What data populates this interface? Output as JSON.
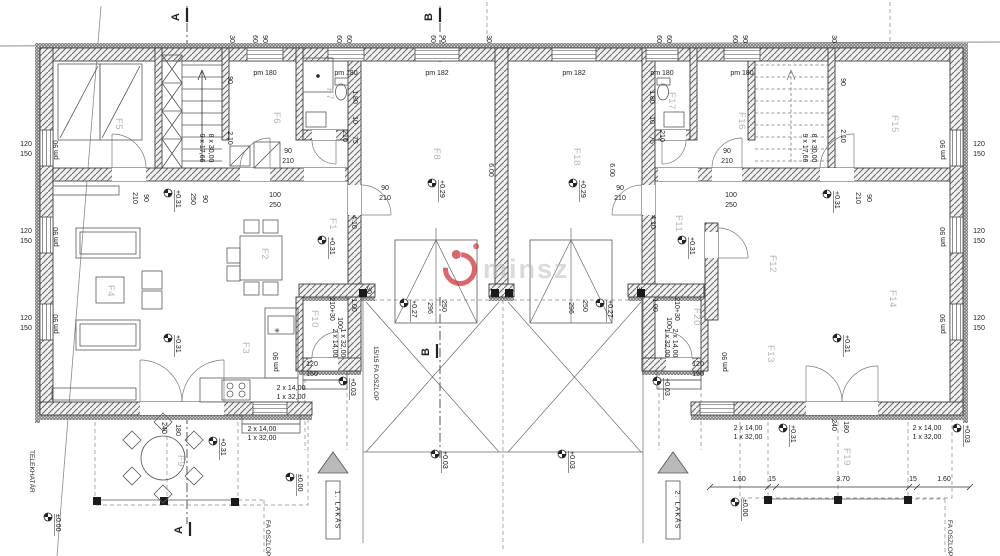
{
  "watermark": {
    "text": "minsz",
    "logo_color": "#c4232b",
    "text_color": "#b5b5b5"
  },
  "apartment_tags": [
    {
      "label": "1. LAKÁS",
      "x": 333
    },
    {
      "label": "2. LAKÁS",
      "x": 673
    }
  ],
  "section_markers": [
    {
      "label": "A",
      "tx": 179,
      "ty": 17,
      "lx": 187,
      "ly": 8
    },
    {
      "label": "B",
      "tx": 432,
      "ty": 17,
      "lx": 440,
      "ly": 8
    },
    {
      "label": "B",
      "tx": 429,
      "ty": 352,
      "lx": 437,
      "ly": 344
    },
    {
      "label": "A",
      "tx": 182,
      "ty": 530,
      "lx": 190,
      "ly": 522
    }
  ],
  "rooms": [
    [
      "F1",
      330,
      218
    ],
    [
      "F2",
      262,
      248
    ],
    [
      "F3",
      243,
      342
    ],
    [
      "F4",
      108,
      285
    ],
    [
      "F5",
      116,
      118
    ],
    [
      "F6",
      274,
      112
    ],
    [
      "F7",
      327,
      88
    ],
    [
      "F8",
      434,
      148
    ],
    [
      "F9",
      178,
      455
    ],
    [
      "F10",
      312,
      310
    ],
    [
      "F11",
      676,
      215
    ],
    [
      "F12",
      770,
      255
    ],
    [
      "F13",
      768,
      345
    ],
    [
      "F14",
      890,
      290
    ],
    [
      "F15",
      892,
      115
    ],
    [
      "F16",
      739,
      112
    ],
    [
      "F17",
      669,
      92
    ],
    [
      "F18",
      574,
      148
    ],
    [
      "F19",
      844,
      448
    ],
    [
      "F20",
      694,
      308
    ]
  ],
  "levels": [
    [
      "+0.31",
      168,
      193
    ],
    [
      "+0.31",
      168,
      338
    ],
    [
      "+0.31",
      322,
      240
    ],
    [
      "+0.29",
      432,
      183
    ],
    [
      "+0.29",
      573,
      183
    ],
    [
      "+0.31",
      682,
      240
    ],
    [
      "+0.31",
      827,
      194
    ],
    [
      "+0.31",
      837,
      338
    ],
    [
      "+0.27",
      404,
      303
    ],
    [
      "+0.27",
      600,
      303
    ],
    [
      "+0.03",
      343,
      381
    ],
    [
      "+0.03",
      657,
      381
    ],
    [
      "+0.03",
      435,
      454
    ],
    [
      "+0.03",
      562,
      454
    ],
    [
      "+0.31",
      213,
      441
    ],
    [
      "+0.31",
      783,
      428
    ],
    [
      "+0.03",
      957,
      428
    ],
    [
      "±0.00",
      290,
      477
    ],
    [
      "±0.00",
      735,
      502
    ],
    [
      "±0.00",
      48,
      517
    ]
  ],
  "dims": [
    [
      "30",
      230,
      39,
      90
    ],
    [
      "60",
      253,
      39,
      90
    ],
    [
      "90",
      263,
      39,
      90
    ],
    [
      "60",
      337,
      39,
      90
    ],
    [
      "60",
      347,
      39,
      90
    ],
    [
      "60",
      431,
      39,
      90
    ],
    [
      "90",
      441,
      39,
      90
    ],
    [
      "30",
      487,
      39,
      90
    ],
    [
      "60",
      657,
      39,
      90
    ],
    [
      "60",
      667,
      39,
      90
    ],
    [
      "60",
      733,
      39,
      90
    ],
    [
      "90",
      743,
      39,
      90
    ],
    [
      "30",
      832,
      39,
      90
    ],
    [
      "pm 180",
      265,
      75,
      0
    ],
    [
      "pm 180",
      346,
      75,
      0
    ],
    [
      "pm 182",
      437,
      75,
      0
    ],
    [
      "pm 182",
      574,
      75,
      0
    ],
    [
      "pm 180",
      662,
      75,
      0
    ],
    [
      "pm 180",
      742,
      75,
      0
    ],
    [
      "120",
      26,
      146,
      0
    ],
    [
      "150",
      26,
      156,
      0
    ],
    [
      "120",
      26,
      233,
      0
    ],
    [
      "150",
      26,
      243,
      0
    ],
    [
      "120",
      26,
      320,
      0
    ],
    [
      "150",
      26,
      330,
      0
    ],
    [
      "pm 90",
      58,
      150,
      -90
    ],
    [
      "pm 90",
      58,
      237,
      -90
    ],
    [
      "pm 90",
      58,
      324,
      -90
    ],
    [
      "120",
      979,
      146,
      0
    ],
    [
      "150",
      979,
      156,
      0
    ],
    [
      "120",
      979,
      233,
      0
    ],
    [
      "150",
      979,
      243,
      0
    ],
    [
      "120",
      979,
      320,
      0
    ],
    [
      "150",
      979,
      330,
      0
    ],
    [
      "pm 90",
      945,
      150,
      -90
    ],
    [
      "pm 90",
      945,
      237,
      -90
    ],
    [
      "pm 90",
      945,
      324,
      -90
    ],
    [
      "90",
      228,
      80,
      90
    ],
    [
      "2.10",
      228,
      138,
      90
    ],
    [
      "9 x 17,66",
      200,
      148,
      90
    ],
    [
      "8 x 30,00",
      209,
      148,
      90
    ],
    [
      "90",
      841,
      82,
      90
    ],
    [
      "2.10",
      841,
      136,
      90
    ],
    [
      "9 x 17,66",
      803,
      148,
      90
    ],
    [
      "8 x 30,00",
      812,
      148,
      90
    ],
    [
      "1.80",
      353,
      97,
      90
    ],
    [
      "10",
      353,
      120,
      90
    ],
    [
      "75",
      353,
      140,
      90
    ],
    [
      "210",
      343,
      136,
      90
    ],
    [
      "1.80",
      650,
      97,
      90
    ],
    [
      "10",
      650,
      120,
      90
    ],
    [
      "75",
      650,
      140,
      90
    ],
    [
      "210",
      660,
      136,
      90
    ],
    [
      "90",
      288,
      153,
      0
    ],
    [
      "210",
      288,
      163,
      0
    ],
    [
      "90",
      727,
      153,
      0
    ],
    [
      "210",
      727,
      163,
      0
    ],
    [
      "210",
      133,
      198,
      90
    ],
    [
      "90",
      144,
      198,
      90
    ],
    [
      "210",
      856,
      198,
      90
    ],
    [
      "90",
      867,
      198,
      90
    ],
    [
      "90",
      385,
      190,
      0
    ],
    [
      "210",
      385,
      200,
      0
    ],
    [
      "90",
      620,
      190,
      0
    ],
    [
      "210",
      620,
      200,
      0
    ],
    [
      "100",
      275,
      197,
      0
    ],
    [
      "250",
      275,
      207,
      0
    ],
    [
      "100",
      731,
      197,
      0
    ],
    [
      "250",
      731,
      207,
      0
    ],
    [
      "250",
      191,
      199,
      90
    ],
    [
      "90",
      203,
      199,
      90
    ],
    [
      "4.10",
      352,
      222,
      90
    ],
    [
      "4.10",
      651,
      222,
      90
    ],
    [
      "6.00",
      489,
      170,
      90
    ],
    [
      "6.00",
      610,
      170,
      90
    ],
    [
      "210+30",
      330,
      309,
      90
    ],
    [
      "1.00",
      352,
      305,
      90
    ],
    [
      "100",
      338,
      323,
      90
    ],
    [
      "210+30",
      675,
      309,
      90
    ],
    [
      "1.00",
      653,
      305,
      90
    ],
    [
      "100",
      667,
      323,
      90
    ],
    [
      "2 x 14,00",
      333,
      343,
      90
    ],
    [
      "1 x 32,00",
      341,
      343,
      90
    ],
    [
      "2 x 14,00",
      673,
      343,
      90
    ],
    [
      "1 x 32,00",
      665,
      343,
      90
    ],
    [
      "120",
      312,
      366,
      0
    ],
    [
      "150",
      312,
      376,
      0
    ],
    [
      "pm 90",
      278,
      362,
      -90
    ],
    [
      "120",
      698,
      366,
      0
    ],
    [
      "150",
      698,
      376,
      0
    ],
    [
      "pm 90",
      727,
      362,
      -90
    ],
    [
      "296",
      428,
      308,
      90
    ],
    [
      "250",
      442,
      306,
      90
    ],
    [
      "296",
      569,
      308,
      90
    ],
    [
      "250",
      583,
      306,
      90
    ],
    [
      "30",
      367,
      290,
      90
    ],
    [
      "30",
      637,
      290,
      90
    ],
    [
      "240",
      162,
      428,
      90
    ],
    [
      "180",
      176,
      430,
      90
    ],
    [
      "240",
      832,
      425,
      90
    ],
    [
      "180",
      844,
      427,
      90
    ],
    [
      "2 x 14,00",
      262,
      431,
      0
    ],
    [
      "1 x 32,00",
      262,
      440,
      0
    ],
    [
      "2 x 14,00",
      291,
      390,
      0
    ],
    [
      "1 x 32,00",
      291,
      399,
      0
    ],
    [
      "2 x 14,00",
      748,
      430,
      0
    ],
    [
      "1 x 32,00",
      748,
      439,
      0
    ],
    [
      "2 x 14,00",
      927,
      430,
      0
    ],
    [
      "1 x 32,00",
      927,
      439,
      0
    ],
    [
      "1.60",
      739,
      481,
      0
    ],
    [
      "15",
      772,
      481,
      0
    ],
    [
      "3.70",
      843,
      481,
      0
    ],
    [
      "15",
      913,
      481,
      0
    ],
    [
      "1.60",
      944,
      481,
      0
    ],
    [
      "✳",
      277,
      333,
      0
    ]
  ],
  "notes": [
    [
      "15/15 FA OSZLOP",
      374,
      346
    ],
    [
      "FA OSZLOP",
      266,
      520
    ],
    [
      "FA OSZLOP",
      948,
      520
    ],
    [
      "TELEKHATÁR",
      30,
      450
    ]
  ]
}
